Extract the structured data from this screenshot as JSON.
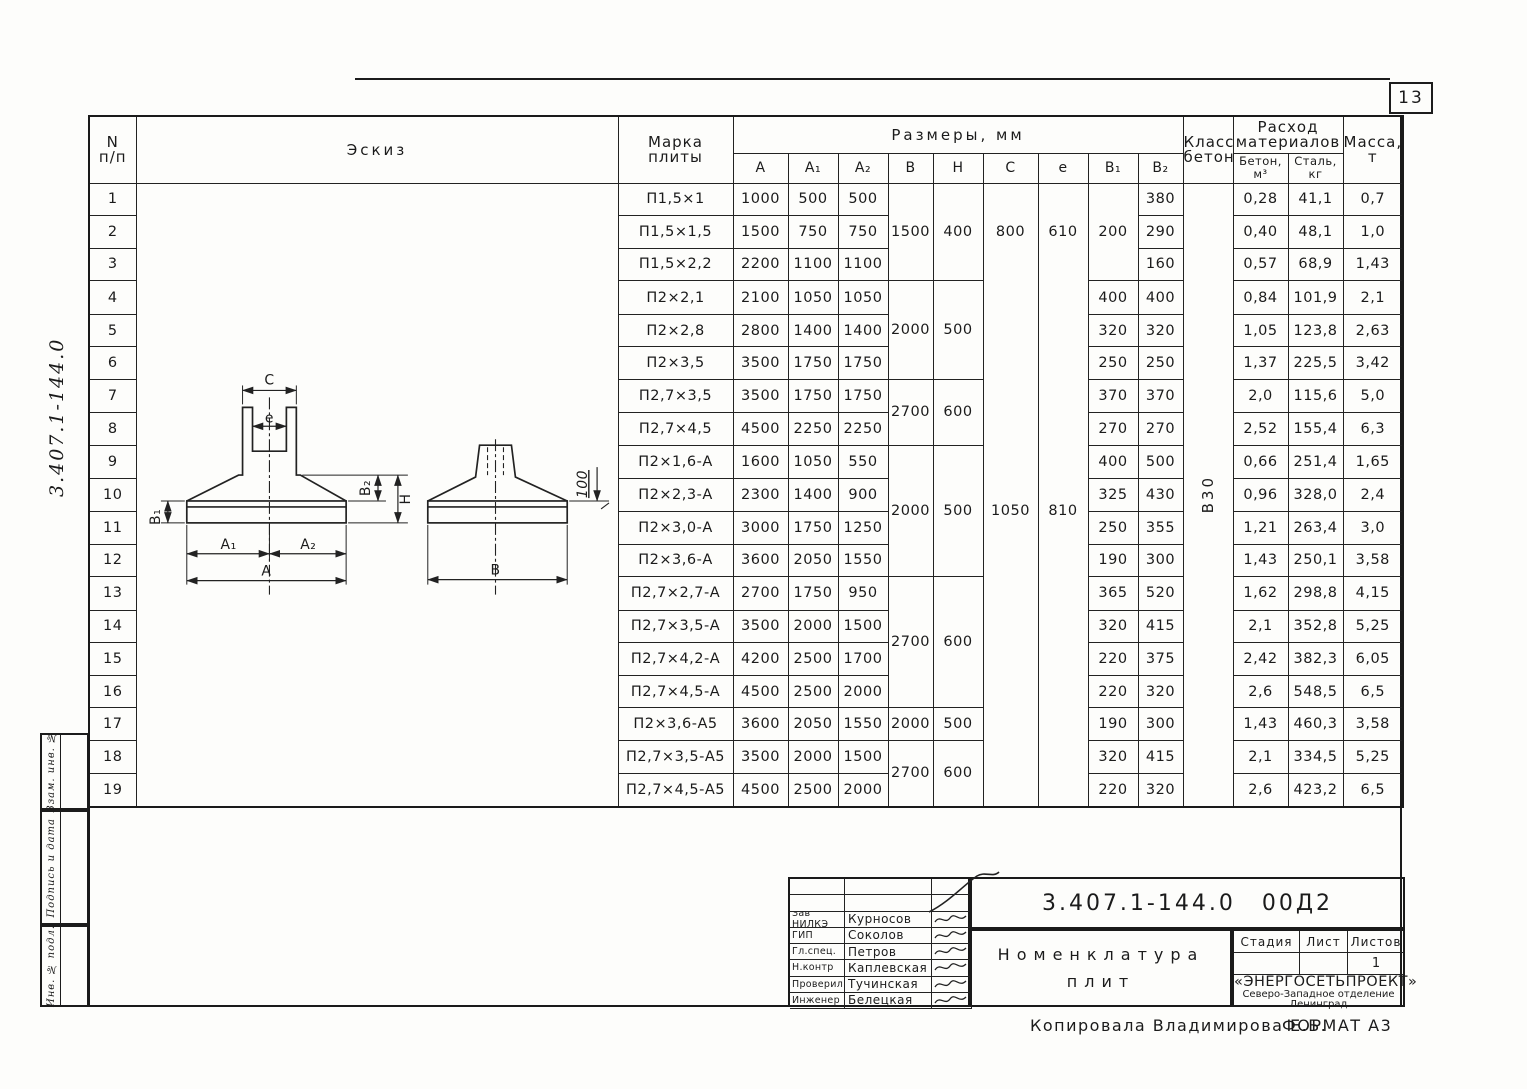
{
  "page": {
    "number": "13"
  },
  "margin": {
    "side_note": "3.407.1-144.0",
    "boxes": [
      "Взам. инв. №",
      "Подпись и дата",
      "Инв. № подл."
    ]
  },
  "table": {
    "headers": {
      "num": [
        "N",
        "п/п"
      ],
      "sketch": "Эскиз",
      "mark": [
        "Марка",
        "плиты"
      ],
      "sizes": "Размеры, мм",
      "dims": [
        "A",
        "A₁",
        "A₂",
        "B",
        "H",
        "C",
        "e",
        "B₁",
        "B₂"
      ],
      "concrete_class": [
        "Класс",
        "бетона"
      ],
      "materials": [
        "Расход",
        "материалов"
      ],
      "concrete": [
        "Бетон,",
        "м³"
      ],
      "steel": [
        "Сталь,",
        "кг"
      ],
      "mass": [
        "Масса,",
        "т"
      ]
    },
    "rows": [
      {
        "num": "1",
        "mark": "П1,5×1",
        "a": "1000",
        "a1": "500",
        "a2": "500",
        "b2": "380",
        "concrete": "0,28",
        "steel": "41,1",
        "mass": "0,7"
      },
      {
        "num": "2",
        "mark": "П1,5×1,5",
        "a": "1500",
        "a1": "750",
        "a2": "750",
        "b2": "290",
        "concrete": "0,40",
        "steel": "48,1",
        "mass": "1,0"
      },
      {
        "num": "3",
        "mark": "П1,5×2,2",
        "a": "2200",
        "a1": "1100",
        "a2": "1100",
        "b2": "160",
        "concrete": "0,57",
        "steel": "68,9",
        "mass": "1,43"
      },
      {
        "num": "4",
        "mark": "П2×2,1",
        "a": "2100",
        "a1": "1050",
        "a2": "1050",
        "b2": "400",
        "concrete": "0,84",
        "steel": "101,9",
        "mass": "2,1"
      },
      {
        "num": "5",
        "mark": "П2×2,8",
        "a": "2800",
        "a1": "1400",
        "a2": "1400",
        "b2": "320",
        "concrete": "1,05",
        "steel": "123,8",
        "mass": "2,63"
      },
      {
        "num": "6",
        "mark": "П2×3,5",
        "a": "3500",
        "a1": "1750",
        "a2": "1750",
        "b2": "250",
        "concrete": "1,37",
        "steel": "225,5",
        "mass": "3,42"
      },
      {
        "num": "7",
        "mark": "П2,7×3,5",
        "a": "3500",
        "a1": "1750",
        "a2": "1750",
        "b2": "370",
        "concrete": "2,0",
        "steel": "115,6",
        "mass": "5,0"
      },
      {
        "num": "8",
        "mark": "П2,7×4,5",
        "a": "4500",
        "a1": "2250",
        "a2": "2250",
        "b2": "270",
        "concrete": "2,52",
        "steel": "155,4",
        "mass": "6,3"
      },
      {
        "num": "9",
        "mark": "П2×1,6-А",
        "a": "1600",
        "a1": "1050",
        "a2": "550",
        "b2": "500",
        "concrete": "0,66",
        "steel": "251,4",
        "mass": "1,65"
      },
      {
        "num": "10",
        "mark": "П2×2,3-А",
        "a": "2300",
        "a1": "1400",
        "a2": "900",
        "b2": "430",
        "concrete": "0,96",
        "steel": "328,0",
        "mass": "2,4"
      },
      {
        "num": "11",
        "mark": "П2×3,0-А",
        "a": "3000",
        "a1": "1750",
        "a2": "1250",
        "b2": "355",
        "concrete": "1,21",
        "steel": "263,4",
        "mass": "3,0"
      },
      {
        "num": "12",
        "mark": "П2×3,6-А",
        "a": "3600",
        "a1": "2050",
        "a2": "1550",
        "b2": "300",
        "concrete": "1,43",
        "steel": "250,1",
        "mass": "3,58"
      },
      {
        "num": "13",
        "mark": "П2,7×2,7-А",
        "a": "2700",
        "a1": "1750",
        "a2": "950",
        "b2": "520",
        "concrete": "1,62",
        "steel": "298,8",
        "mass": "4,15"
      },
      {
        "num": "14",
        "mark": "П2,7×3,5-А",
        "a": "3500",
        "a1": "2000",
        "a2": "1500",
        "b2": "415",
        "concrete": "2,1",
        "steel": "352,8",
        "mass": "5,25"
      },
      {
        "num": "15",
        "mark": "П2,7×4,2-А",
        "a": "4200",
        "a1": "2500",
        "a2": "1700",
        "b2": "375",
        "concrete": "2,42",
        "steel": "382,3",
        "mass": "6,05"
      },
      {
        "num": "16",
        "mark": "П2,7×4,5-А",
        "a": "4500",
        "a1": "2500",
        "a2": "2000",
        "b2": "320",
        "concrete": "2,6",
        "steel": "548,5",
        "mass": "6,5"
      },
      {
        "num": "17",
        "mark": "П2×3,6-А5",
        "a": "3600",
        "a1": "2050",
        "a2": "1550",
        "b2": "300",
        "concrete": "1,43",
        "steel": "460,3",
        "mass": "3,58"
      },
      {
        "num": "18",
        "mark": "П2,7×3,5-А5",
        "a": "3500",
        "a1": "2000",
        "a2": "1500",
        "b2": "415",
        "concrete": "2,1",
        "steel": "334,5",
        "mass": "5,25"
      },
      {
        "num": "19",
        "mark": "П2,7×4,5-А5",
        "a": "4500",
        "a1": "2500",
        "a2": "2000",
        "b2": "320",
        "concrete": "2,6",
        "steel": "423,2",
        "mass": "6,5"
      }
    ],
    "spans": {
      "b": [
        [
          1,
          3,
          "1500"
        ],
        [
          4,
          3,
          "2000"
        ],
        [
          7,
          2,
          "2700"
        ],
        [
          9,
          4,
          "2000"
        ],
        [
          13,
          4,
          "2700"
        ],
        [
          17,
          1,
          "2000"
        ],
        [
          18,
          2,
          "2700"
        ]
      ],
      "h": [
        [
          1,
          3,
          "400"
        ],
        [
          4,
          3,
          "500"
        ],
        [
          7,
          2,
          "600"
        ],
        [
          9,
          4,
          "500"
        ],
        [
          13,
          4,
          "600"
        ],
        [
          17,
          1,
          "500"
        ],
        [
          18,
          2,
          "600"
        ]
      ],
      "c": [
        [
          1,
          3,
          "800",
          "nb"
        ],
        [
          4,
          5,
          "",
          "nt nb"
        ],
        [
          9,
          4,
          "1050",
          "nt nb"
        ],
        [
          13,
          7,
          "",
          "nt"
        ]
      ],
      "e": [
        [
          1,
          3,
          "610",
          "nb"
        ],
        [
          4,
          5,
          "",
          "nt nb"
        ],
        [
          9,
          4,
          "810",
          "nt nb"
        ],
        [
          13,
          7,
          "",
          "nt"
        ]
      ],
      "b1": [
        [
          1,
          3,
          "200"
        ],
        [
          4,
          1,
          "400"
        ],
        [
          5,
          1,
          "320"
        ],
        [
          6,
          1,
          "250"
        ],
        [
          7,
          1,
          "370"
        ],
        [
          8,
          1,
          "270"
        ],
        [
          9,
          1,
          "400"
        ],
        [
          10,
          1,
          "325"
        ],
        [
          11,
          1,
          "250"
        ],
        [
          12,
          1,
          "190"
        ],
        [
          13,
          1,
          "365"
        ],
        [
          14,
          1,
          "320"
        ],
        [
          15,
          1,
          "220"
        ],
        [
          16,
          1,
          "220"
        ],
        [
          17,
          1,
          "190"
        ],
        [
          18,
          1,
          "320"
        ],
        [
          19,
          1,
          "220"
        ]
      ],
      "concrete_class": [
        [
          1,
          19,
          "В30"
        ]
      ]
    }
  },
  "sketch": {
    "labels": {
      "c": "C",
      "e": "e",
      "a1": "A₁",
      "a2": "A₂",
      "a": "A",
      "b": "B",
      "b1": "B₁",
      "b2": "B₂",
      "h": "H",
      "depth": "100"
    }
  },
  "title_block": {
    "doc_number": "3.407.1-144.0 00Д2",
    "title_lines": [
      "Номенклатура",
      "плит"
    ],
    "stage_label": "Стадия",
    "sheet_label": "Лист",
    "sheets_label": "Листов",
    "stage_value": "",
    "sheet_value": "",
    "sheets_value": "1",
    "org_name": "«ЭНЕРГОСЕТЬПРОЕКТ»",
    "org_branch": "Северо-Западное отделение",
    "org_city": "Ленинград",
    "people": [
      [
        "Зав НИЛКЭ",
        "Курносов"
      ],
      [
        "ГИП",
        "Соколов"
      ],
      [
        "Гл.спец.",
        "Петров"
      ],
      [
        "Н.контр",
        "Каплевская"
      ],
      [
        "Проверил",
        "Тучинская"
      ],
      [
        "Инженер",
        "Белецкая"
      ]
    ]
  },
  "footer": {
    "copied": "Копировала Владимирова Е.Б.",
    "format": "ФОРМАТ А3"
  }
}
